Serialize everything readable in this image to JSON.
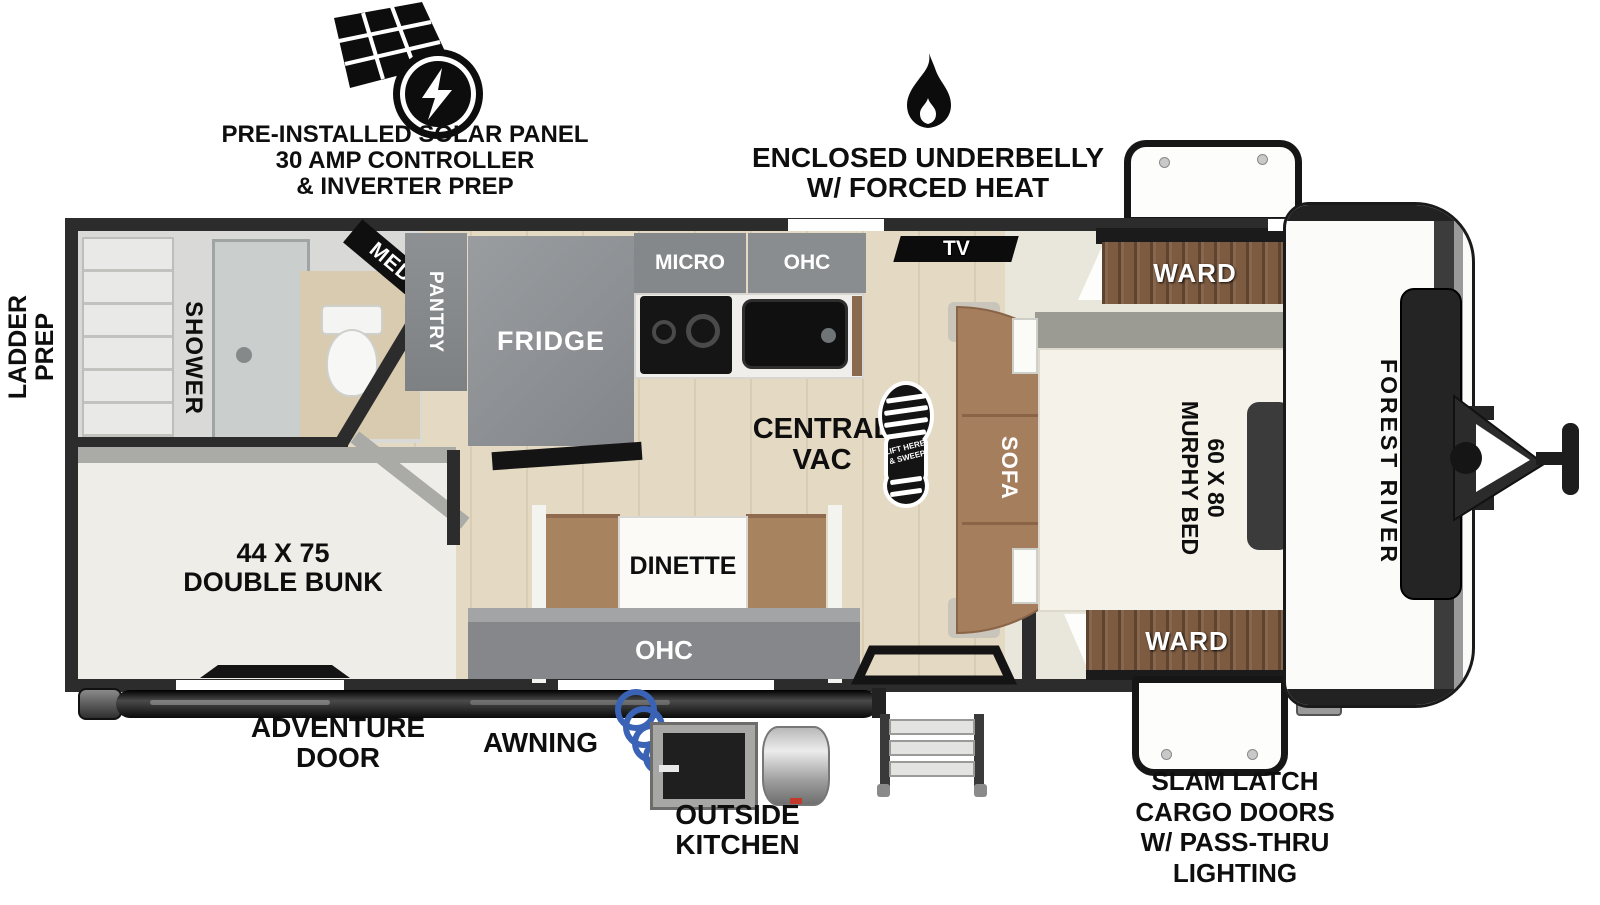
{
  "callouts": {
    "solar": {
      "lines": [
        "PRE-INSTALLED SOLAR PANEL",
        "30 AMP CONTROLLER",
        "& INVERTER PREP"
      ]
    },
    "underbelly": {
      "lines": [
        "ENCLOSED UNDERBELLY",
        "W/ FORCED HEAT"
      ]
    },
    "ladder_prep": {
      "lines": [
        "LADDER",
        "PREP"
      ]
    },
    "adventure_door": {
      "lines": [
        "ADVENTURE",
        "DOOR"
      ]
    },
    "awning": {
      "label": "AWNING"
    },
    "outside_kitchen": {
      "lines": [
        "OUTSIDE",
        "KITCHEN"
      ]
    },
    "cargo_doors": {
      "lines": [
        "SLAM LATCH",
        "CARGO DOORS",
        "W/ PASS-THRU",
        "LIGHTING"
      ]
    }
  },
  "rooms": {
    "bathroom": {
      "shower": "SHOWER",
      "med": "MED"
    },
    "kitchen": {
      "pantry": "PANTRY",
      "fridge": "FRIDGE",
      "micro": "MICRO",
      "ohc": "OHC"
    },
    "living": {
      "tv": "TV",
      "sofa": "SOFA",
      "central_vac": {
        "lines": [
          "CENTRAL",
          "VAC"
        ]
      },
      "boot_print": {
        "lines": [
          "LIFT HERE",
          "& SWEEP"
        ]
      }
    },
    "dinette": {
      "label": "DINETTE",
      "ohc": "OHC"
    },
    "bunk": {
      "lines": [
        "44 X 75",
        "DOUBLE BUNK"
      ]
    },
    "bedroom": {
      "murphy": {
        "lines": [
          "60 X 80",
          "MURPHY BED"
        ]
      },
      "ward_top": "WARD",
      "ward_bottom": "WARD"
    }
  },
  "brand": {
    "name": "FOREST RIVER"
  },
  "colors": {
    "wall": "#2c2c2c",
    "floor_wood": "#e4d9c2",
    "cabinet_gray": "#87898c",
    "ward_wood": "#7d5b40",
    "sofa_brown": "#a57e5e",
    "hose_blue": "#3a63b5"
  }
}
